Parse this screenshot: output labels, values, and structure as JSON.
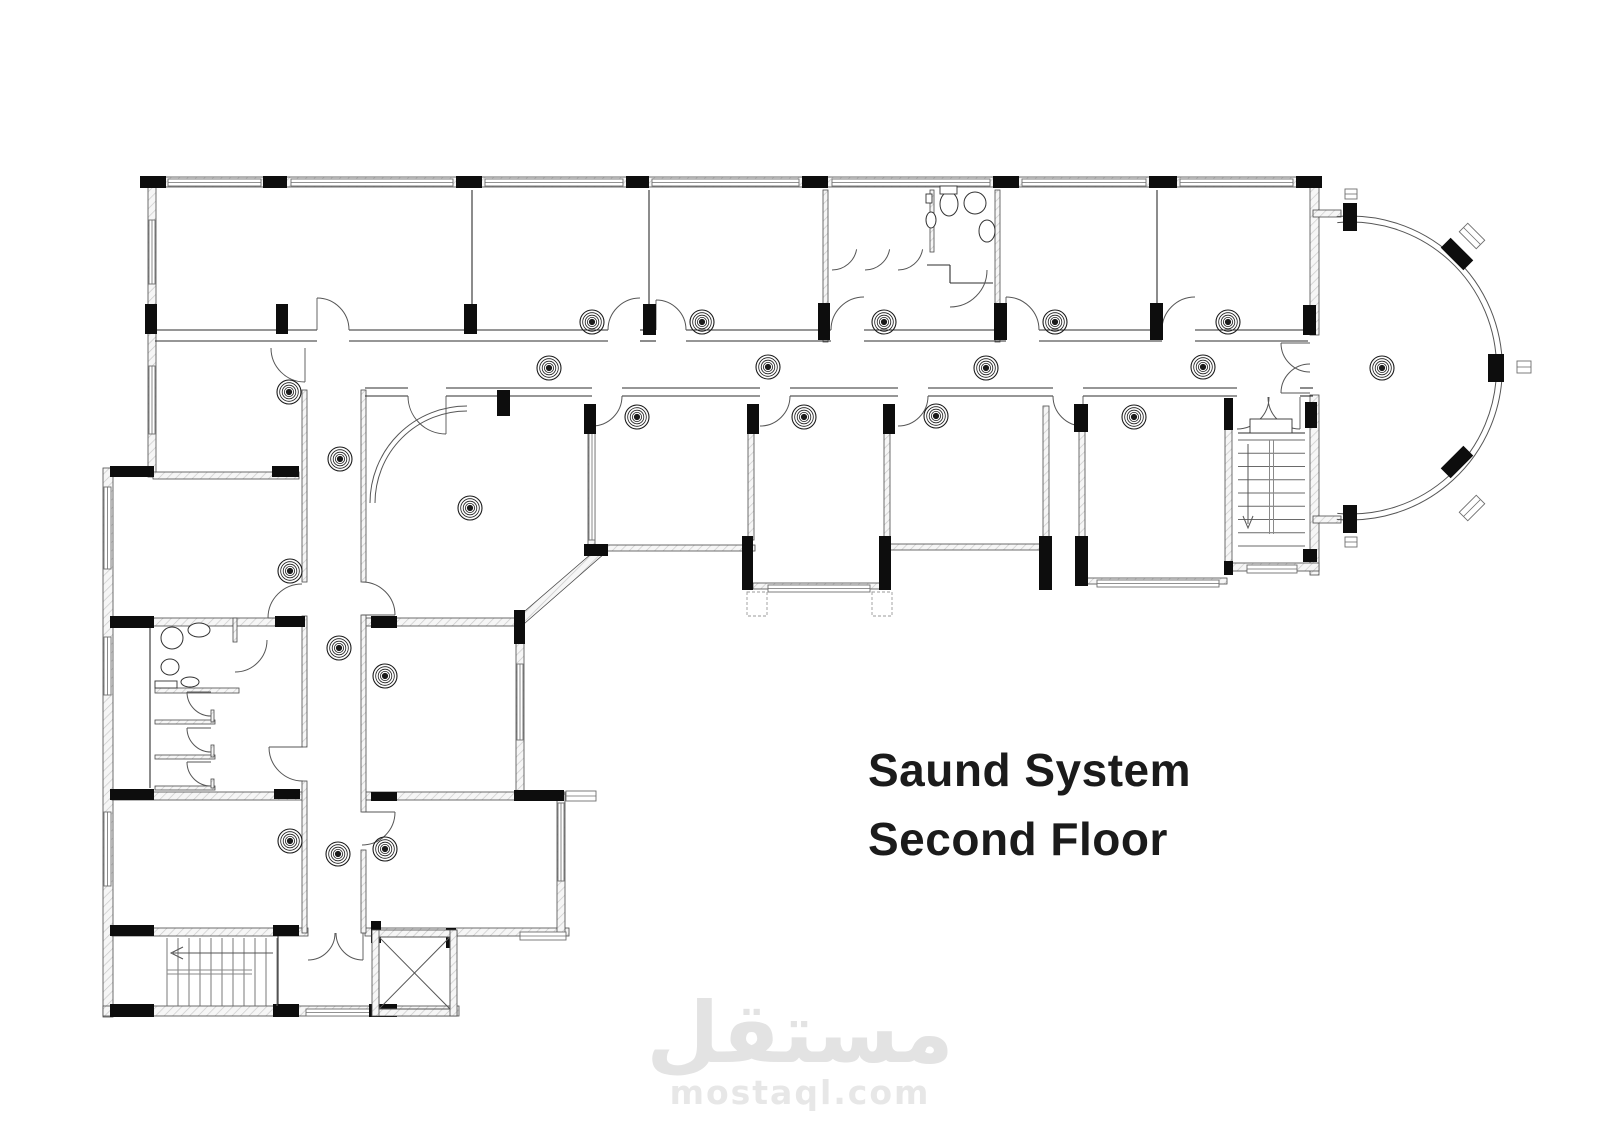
{
  "titles": {
    "line1": "Saund System",
    "line2": "Second Floor"
  },
  "watermark": {
    "arabic": "مستقل",
    "latin": "mostaql.com"
  },
  "colors": {
    "ink": "#1b1b1b",
    "wall_edge": "#4a4a4a",
    "hatch_line": "#c9c9c9",
    "column_fill": "#0d0d0d",
    "thin_line": "#2e2e2e",
    "window_line": "#6e6e6e",
    "watermark_gray": "#e3e3e3",
    "background": "#ffffff"
  },
  "plan": {
    "canvas": {
      "w": 1600,
      "h": 1131
    },
    "walls": [
      [
        143,
        177,
        1177,
        10
      ],
      [
        148,
        187,
        8,
        290
      ],
      [
        1310,
        187,
        9,
        148
      ],
      [
        1310,
        395,
        9,
        180
      ],
      [
        103,
        468,
        10,
        549
      ],
      [
        153,
        472,
        146,
        7
      ],
      [
        112,
        618,
        194,
        8
      ],
      [
        365,
        618,
        158,
        8
      ],
      [
        155,
        688,
        84,
        5
      ],
      [
        155,
        720,
        60,
        4
      ],
      [
        155,
        755,
        60,
        4
      ],
      [
        155,
        786,
        60,
        4
      ],
      [
        112,
        792,
        194,
        8
      ],
      [
        365,
        792,
        200,
        8
      ],
      [
        112,
        928,
        196,
        8
      ],
      [
        365,
        928,
        204,
        8
      ],
      [
        103,
        1006,
        356,
        10
      ],
      [
        516,
        616,
        8,
        182
      ],
      [
        557,
        794,
        8,
        142
      ],
      [
        302,
        390,
        5,
        192
      ],
      [
        302,
        616,
        5,
        131
      ],
      [
        302,
        781,
        5,
        152
      ],
      [
        361,
        390,
        5,
        192
      ],
      [
        361,
        615,
        5,
        197
      ],
      [
        361,
        850,
        5,
        83
      ],
      [
        588,
        406,
        7,
        143
      ],
      [
        748,
        406,
        6,
        134
      ],
      [
        884,
        406,
        6,
        134
      ],
      [
        1043,
        406,
        6,
        141
      ],
      [
        1079,
        430,
        6,
        153
      ],
      [
        1225,
        400,
        7,
        172
      ],
      [
        588,
        545,
        167,
        6
      ],
      [
        753,
        583,
        137,
        6
      ],
      [
        890,
        544,
        159,
        6
      ],
      [
        1086,
        578,
        141,
        6
      ],
      [
        1232,
        563,
        87,
        8
      ],
      [
        823,
        190,
        5,
        152
      ],
      [
        995,
        190,
        5,
        152
      ],
      [
        930,
        190,
        4,
        62
      ],
      [
        233,
        618,
        4,
        24
      ],
      [
        1313,
        210,
        28,
        7
      ],
      [
        1313,
        516,
        28,
        7
      ],
      [
        211,
        710,
        3,
        12
      ],
      [
        211,
        745,
        3,
        12
      ],
      [
        211,
        779,
        3,
        9
      ]
    ],
    "polys": [
      {
        "points": "598,548 605,553 525,623 518,617"
      }
    ],
    "lines": [
      [
        155,
        330,
        317,
        330
      ],
      [
        349,
        330,
        608,
        330
      ],
      [
        640,
        330,
        656,
        330
      ],
      [
        686,
        330,
        831,
        330
      ],
      [
        864,
        330,
        1006,
        330
      ],
      [
        1039,
        330,
        1162,
        330
      ],
      [
        1195,
        330,
        1308,
        330
      ],
      [
        155,
        341,
        317,
        341
      ],
      [
        349,
        341,
        608,
        341
      ],
      [
        640,
        341,
        656,
        341
      ],
      [
        686,
        341,
        831,
        341
      ],
      [
        864,
        341,
        1006,
        341
      ],
      [
        1039,
        341,
        1162,
        341
      ],
      [
        1195,
        341,
        1308,
        341
      ],
      [
        365,
        388,
        408,
        388
      ],
      [
        446,
        388,
        592,
        388
      ],
      [
        622,
        388,
        760,
        388
      ],
      [
        790,
        388,
        898,
        388
      ],
      [
        928,
        388,
        1053,
        388
      ],
      [
        1083,
        388,
        1237,
        388
      ],
      [
        1300,
        388,
        1313,
        388
      ],
      [
        365,
        396,
        408,
        396
      ],
      [
        446,
        396,
        592,
        396
      ],
      [
        622,
        396,
        760,
        396
      ],
      [
        790,
        396,
        898,
        396
      ],
      [
        928,
        396,
        1053,
        396
      ],
      [
        1083,
        396,
        1237,
        396
      ],
      [
        1300,
        396,
        1313,
        396
      ],
      [
        472,
        190,
        472,
        330
      ],
      [
        649,
        190,
        649,
        330
      ],
      [
        1157,
        190,
        1157,
        330
      ],
      [
        927,
        265,
        950,
        265
      ],
      [
        950,
        265,
        950,
        283
      ],
      [
        950,
        283,
        993,
        283
      ],
      [
        278,
        935,
        278,
        1006
      ],
      [
        1238,
        433,
        1305,
        433
      ],
      [
        150,
        620,
        150,
        788
      ]
    ],
    "columns": [
      [
        140,
        176,
        26,
        12
      ],
      [
        263,
        176,
        24,
        12
      ],
      [
        456,
        176,
        26,
        12
      ],
      [
        626,
        176,
        23,
        12
      ],
      [
        802,
        176,
        26,
        12
      ],
      [
        993,
        176,
        26,
        12
      ],
      [
        1149,
        176,
        28,
        12
      ],
      [
        1296,
        176,
        26,
        12
      ],
      [
        145,
        304,
        12,
        30
      ],
      [
        276,
        304,
        12,
        30
      ],
      [
        464,
        304,
        13,
        30
      ],
      [
        643,
        304,
        13,
        31
      ],
      [
        818,
        303,
        12,
        37
      ],
      [
        994,
        303,
        13,
        37
      ],
      [
        1150,
        303,
        13,
        37
      ],
      [
        1303,
        305,
        13,
        30
      ],
      [
        497,
        390,
        13,
        26
      ],
      [
        584,
        404,
        12,
        30
      ],
      [
        747,
        404,
        12,
        30
      ],
      [
        883,
        404,
        12,
        30
      ],
      [
        1074,
        404,
        14,
        28
      ],
      [
        1224,
        398,
        9,
        32
      ],
      [
        1305,
        402,
        12,
        26
      ],
      [
        742,
        536,
        11,
        54
      ],
      [
        879,
        536,
        12,
        54
      ],
      [
        1039,
        536,
        13,
        54
      ],
      [
        584,
        544,
        24,
        12
      ],
      [
        1075,
        536,
        13,
        50
      ],
      [
        1303,
        549,
        14,
        13
      ],
      [
        1224,
        561,
        9,
        14
      ],
      [
        110,
        466,
        44,
        11
      ],
      [
        272,
        466,
        27,
        11
      ],
      [
        110,
        616,
        44,
        12
      ],
      [
        275,
        616,
        30,
        11
      ],
      [
        371,
        616,
        26,
        12
      ],
      [
        514,
        610,
        11,
        34
      ],
      [
        110,
        789,
        44,
        11
      ],
      [
        274,
        789,
        26,
        10
      ],
      [
        371,
        792,
        26,
        9
      ],
      [
        514,
        790,
        50,
        11
      ],
      [
        110,
        925,
        44,
        11
      ],
      [
        273,
        925,
        26,
        11
      ],
      [
        371,
        921,
        10,
        22
      ],
      [
        446,
        928,
        10,
        20
      ],
      [
        110,
        1004,
        44,
        13
      ],
      [
        273,
        1004,
        26,
        13
      ],
      [
        369,
        1004,
        28,
        13
      ],
      [
        1343,
        203,
        14,
        28
      ],
      [
        1343,
        505,
        14,
        28
      ],
      [
        1488,
        354,
        16,
        28
      ],
      [
        1441,
        247,
        32,
        14,
        45
      ],
      [
        1441,
        455,
        32,
        14,
        -45
      ]
    ],
    "windows": [
      [
        168,
        179,
        93,
        7
      ],
      [
        291,
        179,
        162,
        7
      ],
      [
        485,
        179,
        138,
        7
      ],
      [
        652,
        179,
        147,
        7
      ],
      [
        832,
        179,
        158,
        7
      ],
      [
        1022,
        179,
        124,
        7
      ],
      [
        1180,
        179,
        113,
        7
      ],
      [
        149,
        220,
        6,
        64
      ],
      [
        149,
        366,
        6,
        68
      ],
      [
        104,
        487,
        7,
        82
      ],
      [
        104,
        637,
        7,
        58
      ],
      [
        104,
        812,
        7,
        74
      ],
      [
        517,
        664,
        6,
        76
      ],
      [
        558,
        803,
        6,
        78
      ],
      [
        589,
        428,
        6,
        112
      ],
      [
        768,
        585,
        102,
        7
      ],
      [
        1097,
        580,
        122,
        7
      ],
      [
        1247,
        565,
        50,
        8
      ],
      [
        520,
        932,
        46,
        8
      ],
      [
        306,
        1009,
        66,
        7
      ],
      [
        566,
        791,
        30,
        10
      ],
      [
        1345,
        189,
        12,
        10
      ],
      [
        1517,
        361,
        14,
        12
      ],
      [
        1345,
        537,
        12,
        10
      ],
      [
        1460,
        230,
        24,
        12,
        45
      ],
      [
        1460,
        502,
        24,
        12,
        -45
      ]
    ],
    "dashed_windows": [
      [
        747,
        592,
        20,
        24
      ],
      [
        872,
        592,
        20,
        24
      ]
    ],
    "arcs": [
      [
        317,
        330,
        32,
        0,
        90,
        90
      ],
      [
        640,
        330,
        32,
        90,
        180
      ],
      [
        656,
        330,
        30,
        0,
        90,
        90
      ],
      [
        864,
        330,
        33,
        90,
        180
      ],
      [
        1006,
        330,
        33,
        0,
        90,
        90
      ],
      [
        1195,
        330,
        33,
        90,
        180
      ],
      [
        592,
        396,
        30,
        270,
        360
      ],
      [
        760,
        396,
        30,
        270,
        360
      ],
      [
        898,
        396,
        30,
        270,
        360
      ],
      [
        1083,
        396,
        30,
        180,
        270,
        270
      ],
      [
        446,
        396,
        38,
        180,
        270,
        270
      ],
      [
        305,
        348,
        34,
        180,
        270,
        270
      ],
      [
        1310,
        343,
        29,
        180,
        270,
        180
      ],
      [
        1310,
        393,
        29,
        90,
        180,
        180
      ],
      [
        1237,
        397,
        32,
        270,
        360
      ],
      [
        1300,
        397,
        32,
        180,
        270,
        270
      ],
      [
        302,
        618,
        34,
        90,
        180,
        180
      ],
      [
        362,
        615,
        33,
        0,
        90,
        0
      ],
      [
        303,
        747,
        34,
        180,
        270,
        180
      ],
      [
        362,
        812,
        33,
        270,
        360,
        360
      ],
      [
        308,
        933,
        27,
        270,
        360
      ],
      [
        363,
        933,
        27,
        180,
        270,
        270
      ],
      [
        235,
        640,
        32,
        270,
        360
      ],
      [
        211,
        692,
        24,
        180,
        270,
        180
      ],
      [
        211,
        728,
        24,
        180,
        270,
        180
      ],
      [
        211,
        762,
        24,
        180,
        270,
        180
      ],
      [
        832,
        245,
        25,
        270,
        350
      ],
      [
        865,
        245,
        25,
        270,
        350
      ],
      [
        898,
        245,
        25,
        270,
        350
      ],
      [
        950,
        270,
        37,
        270,
        360
      ],
      [
        467,
        503,
        92,
        90,
        180,
        -1
      ],
      [
        467,
        503,
        97,
        90,
        180,
        -1
      ],
      [
        1350,
        368,
        152,
        -95,
        95,
        -1
      ],
      [
        1350,
        368,
        146,
        -95,
        95,
        -1
      ]
    ],
    "speakers": [
      [
        592,
        322
      ],
      [
        702,
        322
      ],
      [
        884,
        322
      ],
      [
        1055,
        322
      ],
      [
        1228,
        322
      ],
      [
        549,
        368
      ],
      [
        768,
        367
      ],
      [
        986,
        368
      ],
      [
        1203,
        367
      ],
      [
        1382,
        368
      ],
      [
        289,
        392
      ],
      [
        637,
        417
      ],
      [
        804,
        417
      ],
      [
        936,
        416
      ],
      [
        1134,
        417
      ],
      [
        470,
        508
      ],
      [
        340,
        459
      ],
      [
        339,
        648
      ],
      [
        338,
        854
      ],
      [
        290,
        571
      ],
      [
        290,
        841
      ],
      [
        385,
        676
      ],
      [
        385,
        849
      ]
    ],
    "stairs": [
      {
        "x": 1238,
        "y": 440,
        "w": 67,
        "h": 106,
        "n": 8,
        "dir": "down"
      },
      {
        "x": 167,
        "y": 938,
        "w": 110,
        "h": 68,
        "n": 10,
        "dir": "left"
      }
    ],
    "elevator": {
      "x": 372,
      "y": 930,
      "w": 85,
      "h": 86,
      "t": 7
    },
    "ellipses": [
      [
        949,
        204,
        9,
        12
      ],
      [
        975,
        203,
        11,
        11
      ],
      [
        931,
        220,
        5,
        8
      ],
      [
        987,
        231,
        8,
        11
      ],
      [
        199,
        630,
        11,
        7
      ],
      [
        172,
        638,
        11,
        11
      ],
      [
        170,
        667,
        9,
        8
      ],
      [
        190,
        682,
        9,
        5
      ]
    ],
    "rects": [
      [
        940,
        186,
        17,
        8
      ],
      [
        926,
        194,
        6,
        9
      ],
      [
        1250,
        419,
        42,
        14
      ],
      [
        155,
        681,
        22,
        7
      ],
      [
        203,
        257,
        0,
        0
      ]
    ]
  }
}
